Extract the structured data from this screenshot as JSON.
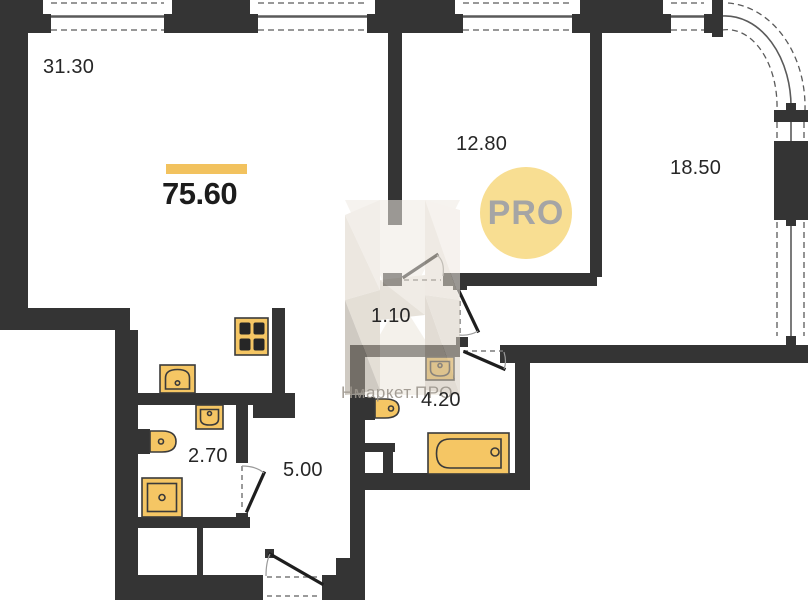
{
  "floorplan": {
    "title": "apartment-floor-plan",
    "total_area": "75.60",
    "rooms": [
      {
        "id": "living-kitchen",
        "area": "31.30"
      },
      {
        "id": "bedroom-1",
        "area": "12.80"
      },
      {
        "id": "bedroom-2",
        "area": "18.50"
      },
      {
        "id": "corridor",
        "area": "1.10"
      },
      {
        "id": "bathroom",
        "area": "4.20"
      },
      {
        "id": "wc",
        "area": "2.70"
      },
      {
        "id": "hallway",
        "area": "5.00"
      }
    ],
    "watermark": {
      "logo_text": "PRO",
      "brand_text": "Нмаркет.ПРО"
    },
    "fixtures": [
      "stove",
      "kitchen-sink",
      "wash-basin-wc",
      "toilet-wc",
      "shower-tray",
      "toilet-bathroom",
      "wash-basin-bathroom",
      "bathtub"
    ],
    "colors": {
      "wall": "#343434",
      "fixture_fill": "#F5C664",
      "accent_bar": "#F2C25E",
      "pro_circle": "#F8DE92",
      "pro_text": "#A5A5A5",
      "watermark_beige": "#DDD4C8"
    }
  }
}
